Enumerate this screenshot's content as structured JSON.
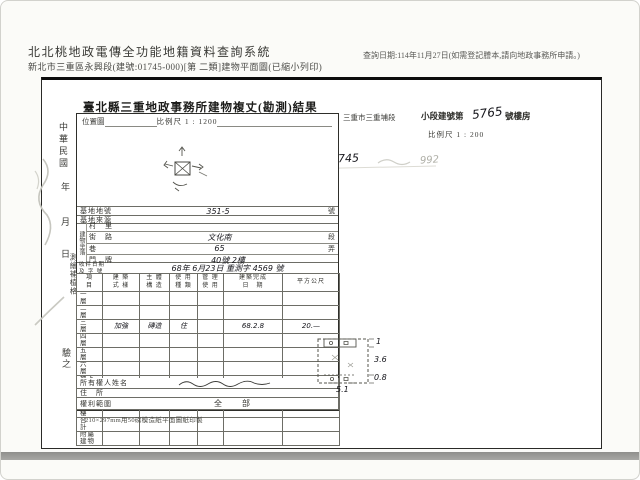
{
  "colors": {
    "paper": "#ffffff",
    "ink": "#2a2a28",
    "hand_ink": "#14141a",
    "pencil": "#b7b7b0",
    "bottom_bar": "#9c9c99"
  },
  "header": {
    "system_title": "北北桃地政電傳全功能地籍資料查詢系統",
    "file_line": "新北市三重區永興段(建號:01745-000)[第 二類]建物平面圖(已縮小列印)",
    "query_note": "查詢日期:114年11月27日(如需登記謄本,請向地政事務所申請。)"
  },
  "doc": {
    "title": "臺北縣三重地政事務所建物複丈(勘測)結果",
    "location": {
      "label": "位置圖",
      "scale": "比例尺 1 : 1200"
    },
    "right_header": {
      "section": "三重市三重埔段",
      "label": "小段建號第",
      "building_no": "5765",
      "suffix": "號樓房",
      "scale": "比例尺 1 : 200"
    },
    "margin": {
      "era": "中華民國",
      "year": "年",
      "month": "月",
      "day": "日",
      "col": "測繪補植格",
      "seal": "驗之"
    },
    "annotation": {
      "new_no": "1745",
      "old_no": "992"
    },
    "fields": {
      "lot_label": "基地地號",
      "lot_value": "351-5",
      "lot_unit": "號",
      "source_label": "基地來源",
      "addr_group": "建物坐落",
      "village_label": "村　里",
      "street_label": "街　路",
      "street_value": "文化南",
      "street_suffix": "段",
      "lane_label": "巷",
      "lane_value": "65",
      "lane_suffix": "弄",
      "door_label": "門　牌",
      "door_value": "40號 2樓",
      "receipt_label_1": "收件日期",
      "receipt_label_2": "及 字 號",
      "receipt_value": "68年 6月23日 重測字 4569 號"
    },
    "floor_table": {
      "columns": [
        [
          "項",
          "目"
        ],
        [
          "建 築",
          "式 樣"
        ],
        [
          "主 體",
          "構 造"
        ],
        [
          "使 用",
          "種 類"
        ],
        [
          "管 理",
          "使 用"
        ],
        [
          "建築完成",
          "日　期"
        ],
        [
          "平方公尺",
          ""
        ]
      ],
      "rows": [
        {
          "label": "一　層",
          "cells": [
            "",
            "",
            "",
            "",
            "",
            ""
          ]
        },
        {
          "label": "二　層",
          "cells": [
            "",
            "",
            "",
            "",
            "",
            ""
          ]
        },
        {
          "label": "三　層",
          "cells": [
            "加強",
            "磚造",
            "住",
            "",
            "68.2.8",
            "20.—"
          ]
        },
        {
          "label": "四　層",
          "cells": [
            "",
            "",
            "",
            "",
            "",
            ""
          ]
        },
        {
          "label": "五　層",
          "cells": [
            "",
            "",
            "",
            "",
            "",
            ""
          ]
        },
        {
          "label": "六　層",
          "cells": [
            "",
            "",
            "",
            "",
            "",
            ""
          ]
        },
        {
          "label": "地下室",
          "cells": [
            "",
            "",
            "",
            "",
            "",
            ""
          ]
        },
        {
          "label": "陽　台",
          "cells": [
            "",
            "",
            "",
            "",
            "",
            "9.—"
          ]
        },
        {
          "label": "騎　樓",
          "cells": [
            "",
            "",
            "",
            "",
            "",
            ""
          ]
        },
        {
          "label": "合　計",
          "cells": [
            "",
            "",
            "",
            "",
            "",
            ""
          ]
        },
        {
          "label": "附屬建物",
          "cells": [
            "",
            "",
            "",
            "",
            "",
            ""
          ]
        }
      ]
    },
    "owner_label": "所有權人姓名",
    "residence_label": "住　所",
    "rights_label": "權利範圍",
    "rights_value": "全　部",
    "footnote": "210×297mm用50磅模造紙平面圖紙印製",
    "sketch": {
      "right_labels": [
        "1",
        "3.6",
        "0.8"
      ],
      "bottom_label": "5.1"
    }
  }
}
